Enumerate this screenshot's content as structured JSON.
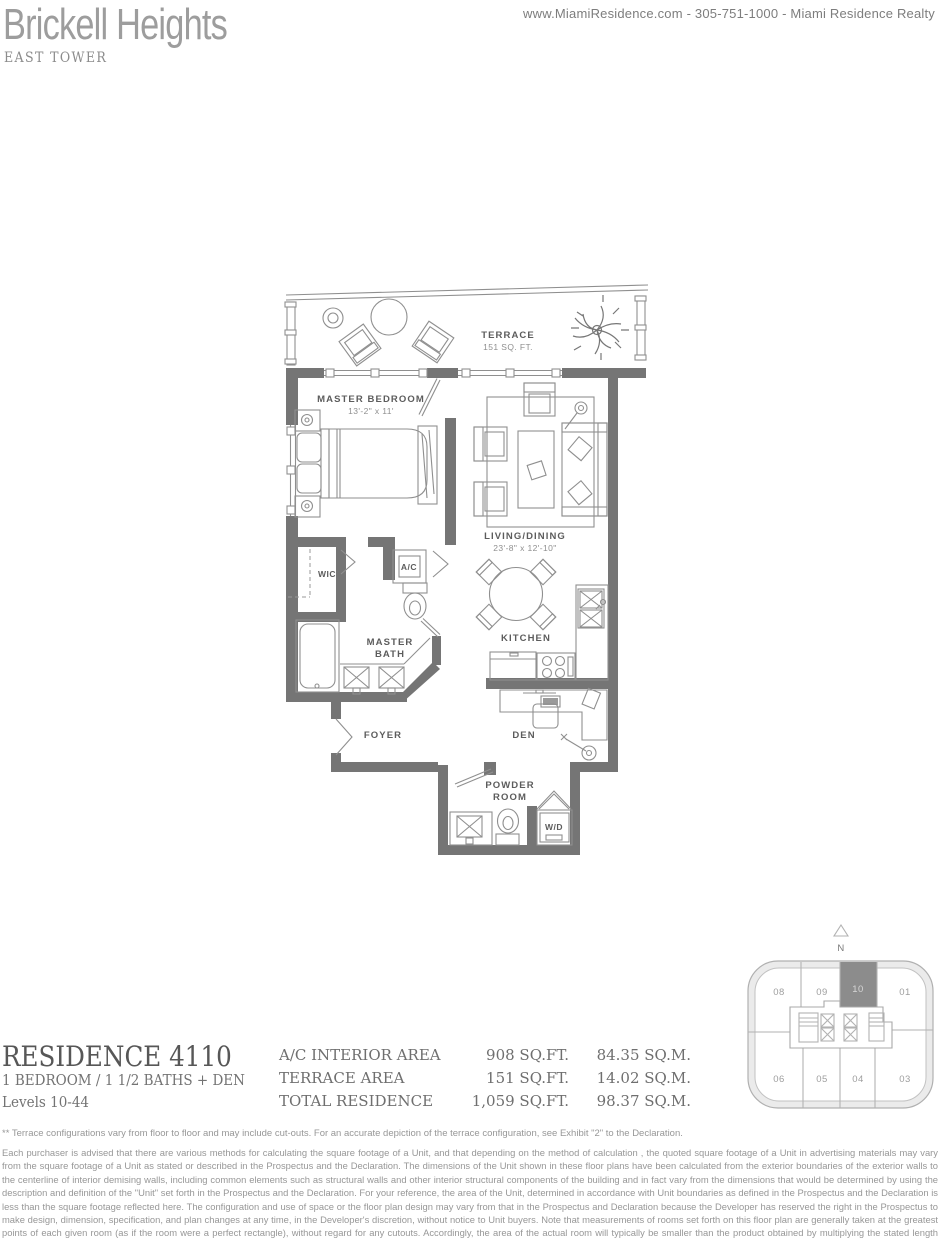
{
  "header": {
    "brand": "Brickell Heights",
    "contact": "www.MiamiResidence.com  -  305-751-1000  -  Miami Residence Realty",
    "tower": "EAST TOWER"
  },
  "floorplan": {
    "terrace_label": "TERRACE",
    "terrace_area": "151 SQ. FT.",
    "master_bedroom_label": "MASTER BEDROOM",
    "master_bedroom_dims": "13'-2\" x 11'",
    "living_label": "LIVING/DINING",
    "living_dims": "23'-8\" x 12'-10\"",
    "wic": "WIC",
    "ac": "A/C",
    "bath_line1": "MASTER",
    "bath_line2": "BATH",
    "kitchen": "KITCHEN",
    "foyer": "FOYER",
    "den": "DEN",
    "powder_line1": "POWDER",
    "powder_line2": "ROOM",
    "wd": "W/D"
  },
  "residence": {
    "title": "RESIDENCE 4110",
    "subtitle": "1 BEDROOM / 1 1/2 BATHS + DEN",
    "levels": "Levels 10-44"
  },
  "areas": {
    "rows": [
      {
        "label": "A/C INTERIOR AREA",
        "sqft": "908 SQ.FT.",
        "sqm": "84.35 SQ.M."
      },
      {
        "label": "TERRACE AREA",
        "sqft": "151 SQ.FT.",
        "sqm": "14.02 SQ.M."
      },
      {
        "label": "TOTAL RESIDENCE",
        "sqft": "1,059 SQ.FT.",
        "sqm": "98.37 SQ.M."
      }
    ]
  },
  "keyplan": {
    "north": "N",
    "units_top": [
      "08",
      "09",
      "10",
      "01"
    ],
    "units_bottom": [
      "06",
      "05",
      "04",
      "03"
    ],
    "highlighted_unit": "10",
    "highlight_color": "#8c8c8c"
  },
  "disclaimer": {
    "note": "** Terrace configurations vary from floor to floor and may include cut-outs.  For an accurate depiction of the terrace configuration, see Exhibit \"2\" to the Declaration.",
    "body": "Each purchaser is advised that there are various methods for calculating the square footage of a Unit, and that depending on the method of calculation , the quoted square footage of a Unit in advertising materials may vary from the square footage of a Unit as stated or described in the Prospectus and the Declaration.  The dimensions of the Unit shown in these floor plans have been calculated from the exterior boundaries of the exterior walls to the centerline of interior demising walls, including common elements such as structural walls and other interior structural components of the building and in fact vary from the dimensions that would be determined by using the description and definition of the \"Unit\" set forth in the Prospectus and the Declaration.  For your reference, the area of the Unit, determined in accordance with Unit boundaries as defined in the Prospectus and the Declaration is less than the square footage reflected here. The configuration and use of space or the floor plan design may vary from that in the Prospectus and Declaration because the Developer has reserved the right in the Prospectus to make design, dimension, specification, and plan changes at any time, in the Developer's discretion, without notice to Unit buyers. Note that measurements of rooms set forth on this floor plan are generally taken at the greatest points of each given room (as if the room were a perfect rectangle), without regard for any cutouts.  Accordingly, the area of the actual room will typically be smaller than the product obtained by multiplying the stated length times width.  All dimensions are approximate and may vary with actual construction, and all floor plans and development plans are subject to change.  The furnishings and décor illustrated are not included with the purchase of the Unit. See Prospectus for additional information regarding what is offered with the Unit and the calculation of Unit square footage and dimensions."
  },
  "colors": {
    "wall": "#757575",
    "thin_line": "#8f8f8f",
    "highlight": "#8c8c8c"
  }
}
